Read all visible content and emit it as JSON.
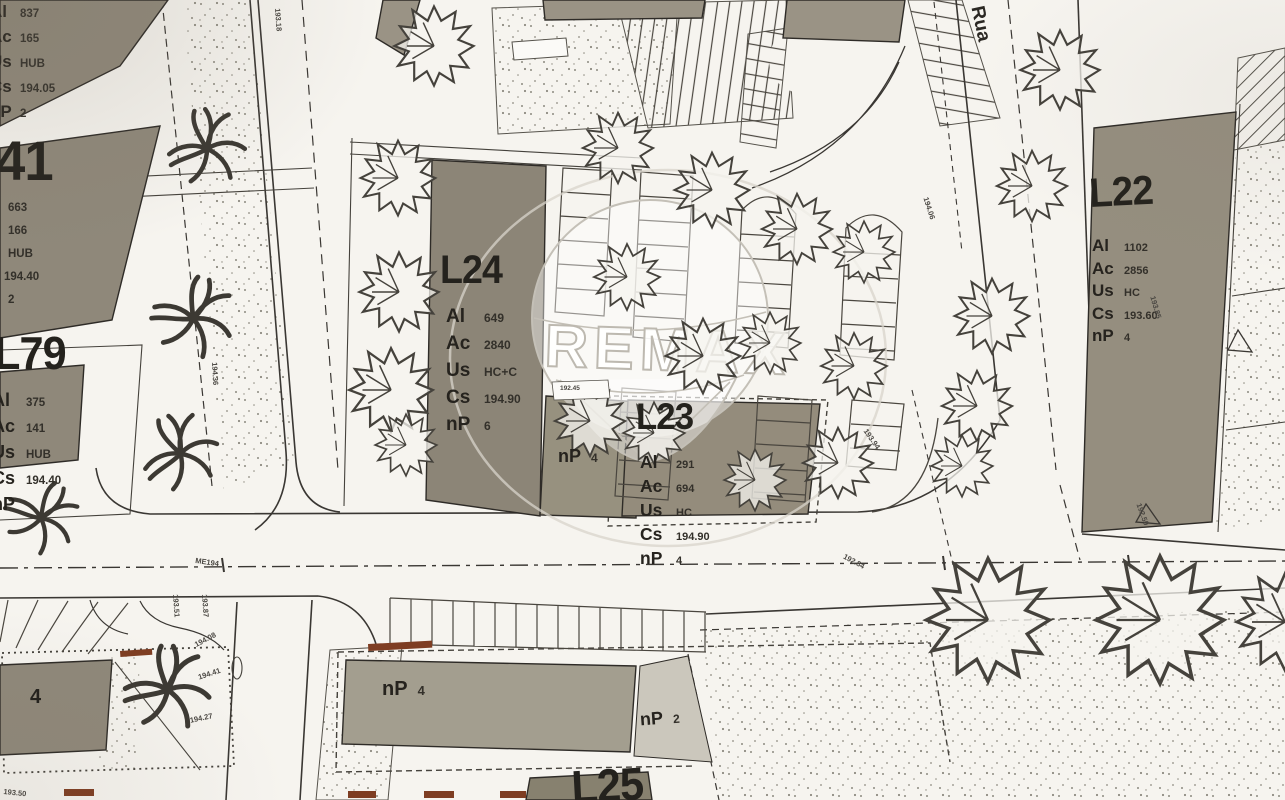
{
  "watermark": {
    "brand": "REMAX"
  },
  "street": {
    "name": "Rua"
  },
  "lots": {
    "top_left": {
      "rows": [
        {
          "k": "Al",
          "v": "837"
        },
        {
          "k": "Ac",
          "v": "165"
        },
        {
          "k": "Us",
          "v": "HUB"
        },
        {
          "k": "Cs",
          "v": "194.05"
        },
        {
          "k": "nP",
          "v": "2"
        }
      ]
    },
    "l41": {
      "id": "41",
      "values": [
        "663",
        "166",
        "HUB",
        "194.40",
        "2"
      ]
    },
    "l79": {
      "id": "L79",
      "rows": [
        {
          "k": "Al",
          "v": "375"
        },
        {
          "k": "Ac",
          "v": "141"
        },
        {
          "k": "Us",
          "v": "HUB"
        },
        {
          "k": "Cs",
          "v": "194.40"
        },
        {
          "k": "nP",
          "v": ""
        }
      ]
    },
    "l24": {
      "id": "L24",
      "rows": [
        {
          "k": "Al",
          "v": "649"
        },
        {
          "k": "Ac",
          "v": "2840"
        },
        {
          "k": "Us",
          "v": "HC+C"
        },
        {
          "k": "Cs",
          "v": "194.90"
        },
        {
          "k": "nP",
          "v": "6"
        }
      ]
    },
    "l23": {
      "id": "L23",
      "rows": [
        {
          "k": "Al",
          "v": "291"
        },
        {
          "k": "Ac",
          "v": "694"
        },
        {
          "k": "Us",
          "v": "HC"
        },
        {
          "k": "Cs",
          "v": "194.90"
        },
        {
          "k": "nP",
          "v": "4"
        }
      ]
    },
    "l22": {
      "id": "L22",
      "rows": [
        {
          "k": "Al",
          "v": "1102"
        },
        {
          "k": "Ac",
          "v": "2856"
        },
        {
          "k": "Us",
          "v": "HC"
        },
        {
          "k": "Cs",
          "v": "193.60"
        },
        {
          "k": "nP",
          "v": "4"
        }
      ]
    },
    "l25": {
      "id": "L25"
    },
    "np_l24_side": {
      "k": "nP",
      "v": "4"
    },
    "np_bottom_building": {
      "k": "nP",
      "v": "4"
    },
    "np_bottom_lot": {
      "k": "nP",
      "v": "2"
    },
    "bl_building_label": "4"
  },
  "markers": {
    "bench_elevation": "192.45"
  },
  "survey": [
    {
      "text": "193.18"
    },
    {
      "text": "194.06"
    },
    {
      "text": "193.94"
    },
    {
      "text": "192.84"
    },
    {
      "text": "ME194"
    },
    {
      "text": "193.51"
    },
    {
      "text": "193.87"
    },
    {
      "text": "194.08"
    },
    {
      "text": "194.41"
    },
    {
      "text": "194.27"
    },
    {
      "text": "193.50"
    },
    {
      "text": "193.85"
    },
    {
      "text": "192.50"
    },
    {
      "text": "194.36"
    }
  ]
}
